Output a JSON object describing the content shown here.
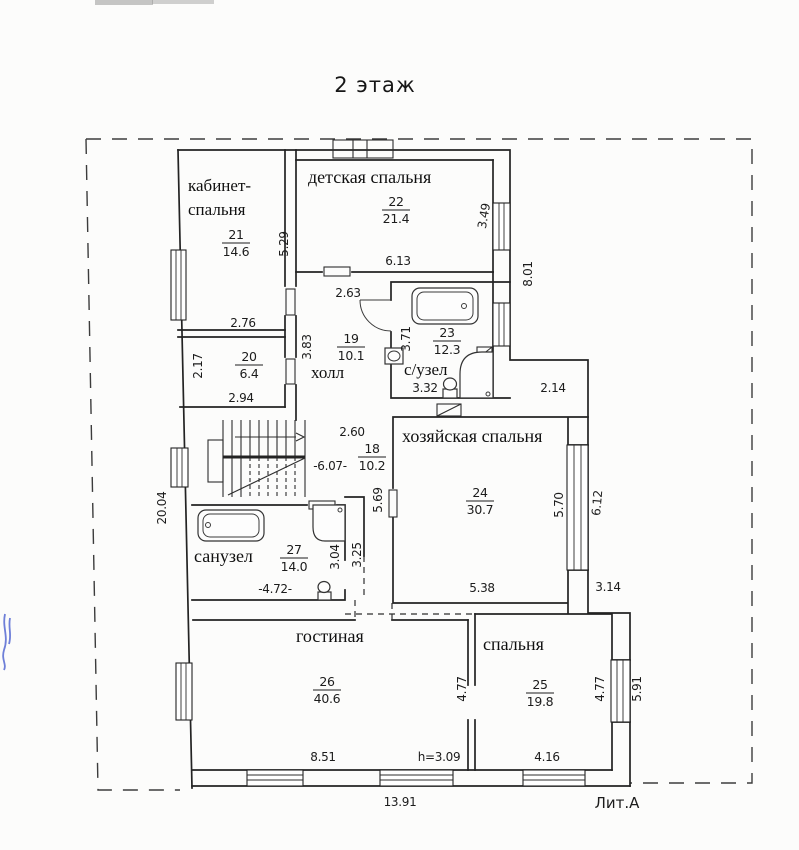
{
  "title": "2 этаж",
  "litera": "Лит.А",
  "rooms": {
    "cabinet": {
      "name_line1": "кабинет-",
      "name_line2": "спальня",
      "number": "21",
      "area": "14.6"
    },
    "children": {
      "name": "детская спальня",
      "number": "22",
      "area": "21.4"
    },
    "hall": {
      "name": "холл",
      "number": "19",
      "area": "10.1"
    },
    "room20": {
      "number": "20",
      "area": "6.4"
    },
    "wc": {
      "name": "с/узел",
      "number": "23",
      "area": "12.3"
    },
    "stairhall": {
      "number": "18",
      "area": "10.2"
    },
    "master": {
      "name": "хозяйская спальня",
      "number": "24",
      "area": "30.7"
    },
    "bath": {
      "name": "санузел",
      "number": "27",
      "area": "14.0"
    },
    "living": {
      "name": "гостиная",
      "number": "26",
      "area": "40.6"
    },
    "bedroom": {
      "name": "спальня",
      "number": "25",
      "area": "19.8"
    }
  },
  "dims": {
    "cabinet_height": "5.29",
    "cabinet_width": "2.76",
    "children_width": "6.13",
    "children_window": "3.49",
    "right_wall_upper": "8.01",
    "hall_top": "2.63",
    "hall_height": "3.83",
    "room20_height": "2.17",
    "room20_width": "2.94",
    "wc_height": "3.71",
    "wc_width": "3.32",
    "passage_width": "2.14",
    "stairs_top": "2.60",
    "stairs_width": "-6.07-",
    "stairs_height": "5.69",
    "left_wall_total": "20.04",
    "master_window": "5.70",
    "master_window_ext": "6.12",
    "master_width": "5.38",
    "step_width": "3.14",
    "bath_height": "3.04",
    "bath_ext": "3.25",
    "bath_width": "-4.72-",
    "living_width": "8.51",
    "ceiling_height": "h=3.09",
    "divider_height": "4.77",
    "bedroom_window": "4.77",
    "bedroom_window_ext": "5.91",
    "bedroom_width": "4.16",
    "bottom_total": "13.91"
  }
}
